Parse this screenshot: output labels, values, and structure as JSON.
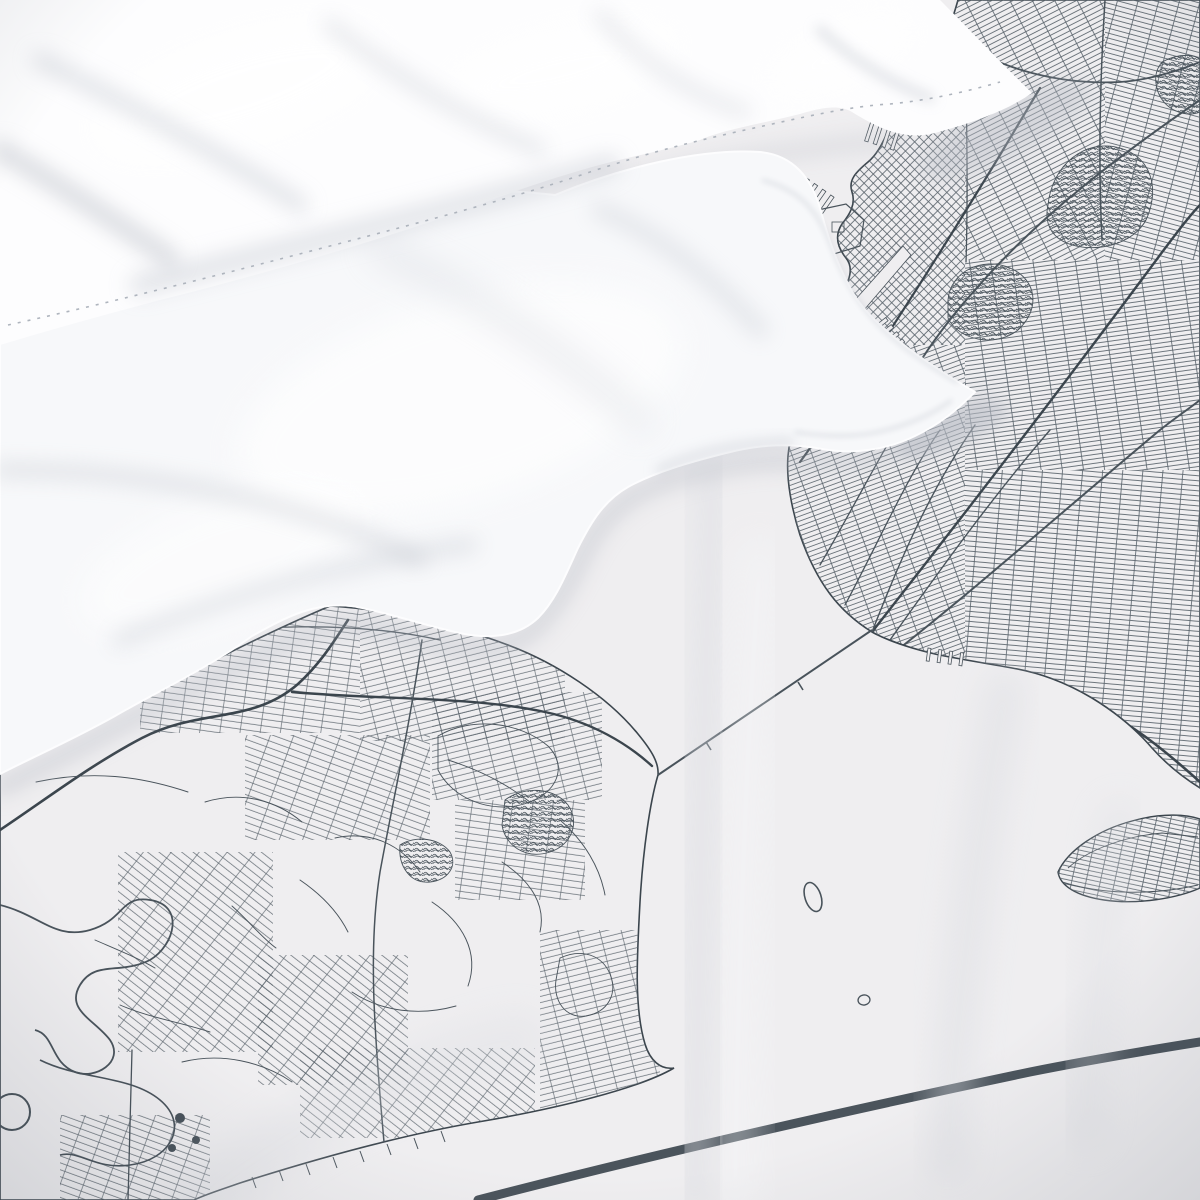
{
  "scene": {
    "type": "natural-image",
    "subject": "White bedding set with a monochrome city street-map printed duvet cover, photographed from above",
    "setting": "studio product photo, soft daylight",
    "objects": [
      {
        "name": "pillow-top",
        "description": "white pillow lying diagonally across the top with a stitched hem and a corner tip pointing right"
      },
      {
        "name": "pillow-front",
        "description": "second white pillow with a flanged (Oxford) corner pointing right over the duvet"
      },
      {
        "name": "duvet-map-print",
        "description": "white duvet cover printed with a dark slate-grey street map of a harbor city: dense Brooklyn-style grids on the right, an irregular island of streets lower left, open water between, a thin suspension-bridge line across the narrows, a small gridded island at lower right and a thick map frame border crossing the bottom corner"
      }
    ],
    "map_features": [
      "dense rectilinear street grids in several orientations",
      "coastlines with piers and dock basins",
      "curving expressways and avenues",
      "winding creeks and a round pond",
      "parks and cemeteries drawn as scribbled patches",
      "straight suspension-bridge line over the water",
      "two small outlined harbor islands",
      "gridded beach island at lower right",
      "thick diagonal map frame border line"
    ]
  },
  "palette": {
    "fabric_base": "#eeedef",
    "map_fabric": "#efeef0",
    "map_line_fine": "#5a646c",
    "map_line": "#49535b",
    "map_line_strong": "#3b454d",
    "border_line": "#4b545c",
    "pillow_white": "#f7f8fa",
    "pillow_bright": "#fdfdfe",
    "crease_gray": "#c9cdd5",
    "crease_deep": "#b4b8c1",
    "stitch_gray": "#aeb4bd",
    "fold_light": "#dadce1",
    "shadow_soft": "#b7bbc4"
  }
}
